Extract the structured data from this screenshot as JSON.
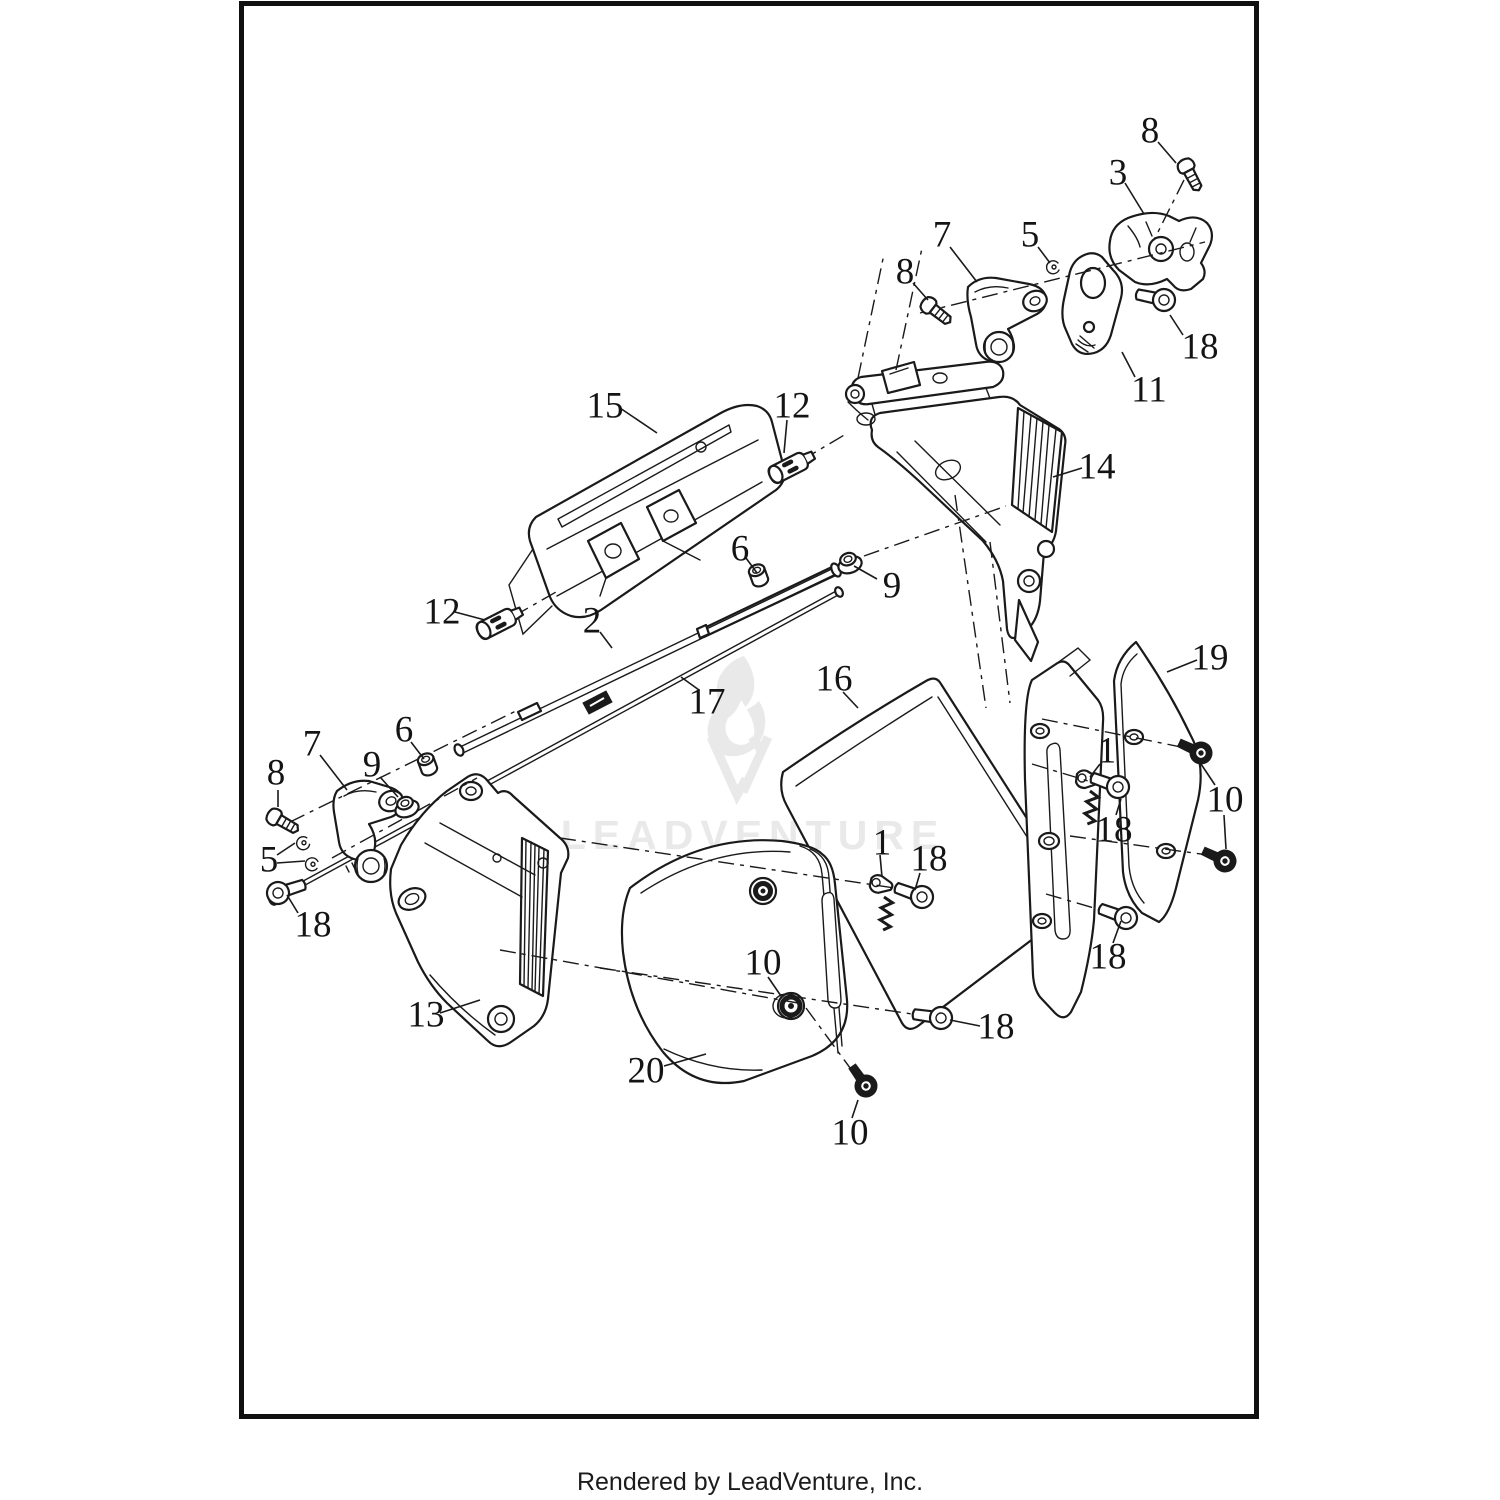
{
  "page": {
    "background": "#ffffff",
    "border_color": "#101010",
    "footer": "Rendered by LeadVenture, Inc."
  },
  "watermark": {
    "text": "LEADVENTURE",
    "color": "#e9e9e9"
  },
  "diagram": {
    "type": "exploded-parts-diagram",
    "line_color": "#1a1a1a",
    "callout_font_size": 37,
    "part_numbers_visible": [
      "1",
      "2",
      "3",
      "5",
      "6",
      "7",
      "8",
      "9",
      "10",
      "11",
      "12",
      "13",
      "14",
      "15",
      "16",
      "17",
      "18",
      "19",
      "20"
    ],
    "callouts": [
      {
        "n": "8",
        "x": 1150,
        "y": 131,
        "leaders": [
          [
            1158,
            142,
            1176,
            163
          ]
        ]
      },
      {
        "n": "3",
        "x": 1118,
        "y": 173,
        "leaders": [
          [
            1125,
            183,
            1144,
            214
          ]
        ]
      },
      {
        "n": "7",
        "x": 942,
        "y": 235,
        "leaders": [
          [
            950,
            247,
            977,
            282
          ]
        ]
      },
      {
        "n": "5",
        "x": 1030,
        "y": 235,
        "leaders": [
          [
            1038,
            247,
            1050,
            263
          ]
        ]
      },
      {
        "n": "8",
        "x": 905,
        "y": 272,
        "leaders": [
          [
            913,
            283,
            928,
            300
          ]
        ]
      },
      {
        "n": "18",
        "x": 1200,
        "y": 347,
        "leaders": [
          [
            1183,
            335,
            1170,
            315
          ]
        ]
      },
      {
        "n": "11",
        "x": 1149,
        "y": 390,
        "leaders": [
          [
            1135,
            377,
            1122,
            352
          ]
        ]
      },
      {
        "n": "15",
        "x": 605,
        "y": 406,
        "leaders": [
          [
            620,
            408,
            657,
            433
          ]
        ]
      },
      {
        "n": "12",
        "x": 792,
        "y": 406,
        "leaders": [
          [
            787,
            420,
            784,
            453
          ]
        ]
      },
      {
        "n": "14",
        "x": 1097,
        "y": 467,
        "leaders": [
          [
            1082,
            468,
            1053,
            477
          ]
        ]
      },
      {
        "n": "6",
        "x": 740,
        "y": 549,
        "leaders": [
          [
            746,
            558,
            757,
            573
          ]
        ]
      },
      {
        "n": "9",
        "x": 892,
        "y": 586,
        "leaders": [
          [
            877,
            579,
            854,
            566
          ]
        ]
      },
      {
        "n": "12",
        "x": 442,
        "y": 612,
        "leaders": [
          [
            455,
            612,
            485,
            620
          ]
        ]
      },
      {
        "n": "2",
        "x": 592,
        "y": 621,
        "leaders": [
          [
            600,
            632,
            612,
            648
          ]
        ]
      },
      {
        "n": "16",
        "x": 834,
        "y": 679,
        "leaders": [
          [
            843,
            692,
            858,
            708
          ]
        ]
      },
      {
        "n": "19",
        "x": 1210,
        "y": 658,
        "leaders": [
          [
            1197,
            660,
            1167,
            672
          ]
        ]
      },
      {
        "n": "17",
        "x": 707,
        "y": 702,
        "leaders": [
          [
            699,
            690,
            681,
            677
          ]
        ]
      },
      {
        "n": "6",
        "x": 404,
        "y": 730,
        "leaders": [
          [
            411,
            742,
            424,
            759
          ]
        ]
      },
      {
        "n": "7",
        "x": 312,
        "y": 744,
        "leaders": [
          [
            320,
            755,
            347,
            790
          ]
        ]
      },
      {
        "n": "9",
        "x": 372,
        "y": 765,
        "leaders": [
          [
            380,
            777,
            398,
            797
          ]
        ]
      },
      {
        "n": "8",
        "x": 276,
        "y": 773,
        "leaders": [
          [
            278,
            790,
            278,
            807
          ]
        ]
      },
      {
        "n": "1",
        "x": 1107,
        "y": 751,
        "leaders": [
          [
            1100,
            764,
            1090,
            777
          ]
        ]
      },
      {
        "n": "10",
        "x": 1225,
        "y": 800,
        "leaders": [
          [
            1215,
            785,
            1201,
            764
          ],
          [
            1224,
            815,
            1226,
            849
          ]
        ]
      },
      {
        "n": "18",
        "x": 1114,
        "y": 830,
        "leaders": [
          [
            1116,
            815,
            1121,
            799
          ]
        ]
      },
      {
        "n": "1",
        "x": 882,
        "y": 843,
        "leaders": [
          [
            880,
            855,
            882,
            877
          ]
        ]
      },
      {
        "n": "18",
        "x": 929,
        "y": 859,
        "leaders": [
          [
            920,
            873,
            915,
            890
          ]
        ]
      },
      {
        "n": "5",
        "x": 269,
        "y": 860,
        "leaders": [
          [
            277,
            855,
            295,
            843
          ],
          [
            277,
            863,
            305,
            861
          ]
        ]
      },
      {
        "n": "18",
        "x": 313,
        "y": 925,
        "leaders": [
          [
            298,
            913,
            287,
            895
          ]
        ]
      },
      {
        "n": "10",
        "x": 763,
        "y": 963,
        "leaders": [
          [
            768,
            977,
            781,
            996
          ]
        ]
      },
      {
        "n": "18",
        "x": 1108,
        "y": 957,
        "leaders": [
          [
            1113,
            943,
            1121,
            921
          ]
        ]
      },
      {
        "n": "13",
        "x": 426,
        "y": 1015,
        "leaders": [
          [
            440,
            1013,
            480,
            1000
          ]
        ]
      },
      {
        "n": "18",
        "x": 996,
        "y": 1027,
        "leaders": [
          [
            980,
            1026,
            950,
            1020
          ]
        ]
      },
      {
        "n": "20",
        "x": 646,
        "y": 1071,
        "leaders": [
          [
            664,
            1066,
            706,
            1054
          ]
        ]
      },
      {
        "n": "10",
        "x": 850,
        "y": 1133,
        "leaders": [
          [
            852,
            1118,
            858,
            1100
          ]
        ]
      }
    ],
    "axis_lines": [
      [
        920,
        313,
        1205,
        242
      ],
      [
        858,
        378,
        884,
        254
      ],
      [
        896,
        370,
        922,
        248
      ],
      [
        1184,
        180,
        1154,
        240
      ],
      [
        290,
        822,
        518,
        710
      ],
      [
        332,
        858,
        477,
        778
      ],
      [
        864,
        556,
        1006,
        506
      ],
      [
        955,
        495,
        986,
        708
      ],
      [
        990,
        542,
        1010,
        703
      ],
      [
        560,
        838,
        908,
        890
      ],
      [
        600,
        968,
        946,
        1019
      ],
      [
        1042,
        719,
        1206,
        752
      ],
      [
        1070,
        836,
        1230,
        858
      ],
      [
        1032,
        764,
        1128,
        793
      ],
      [
        1046,
        894,
        1118,
        915
      ],
      [
        500,
        950,
        798,
        1003
      ],
      [
        806,
        1008,
        856,
        1076
      ],
      [
        802,
        460,
        846,
        434
      ],
      [
        514,
        616,
        556,
        592
      ]
    ]
  }
}
